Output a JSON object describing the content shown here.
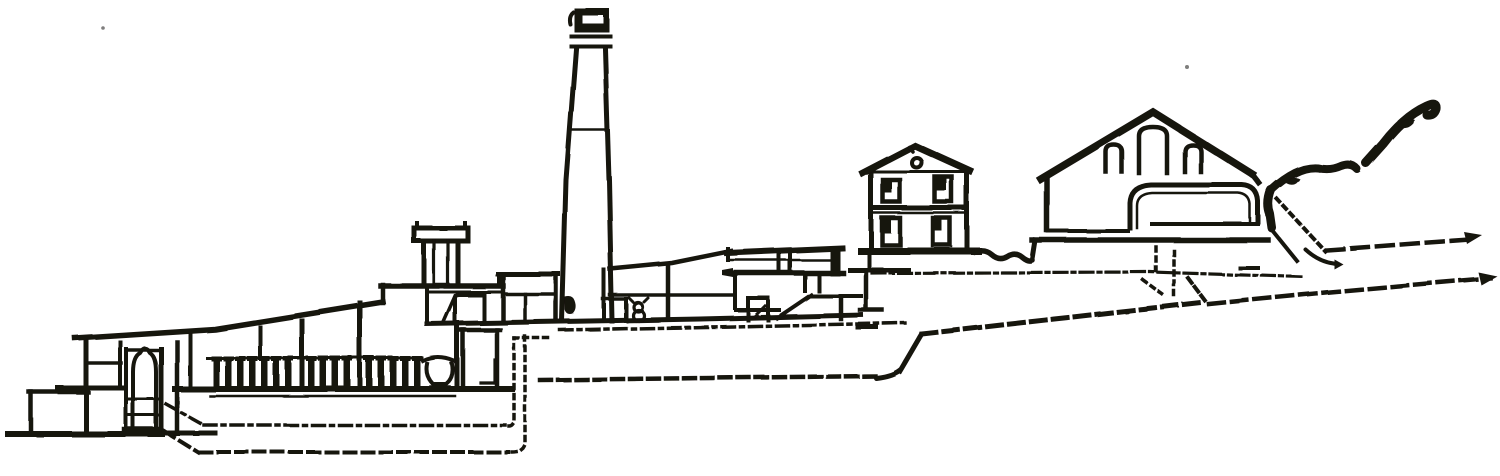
{
  "title": "Sectional elevation engraving of a terraced hillside smelting works with tall central chimney",
  "description": "Old black-ink line engraving, white background, no lettering. From left to right: a low machine house with an enclosed still or vessel; an open shed whose sloping roof covers a long row of short condenser columns and a collecting pot; a furnace block carrying a small capped chimney; a tall tapering smokestack with a moulded cap; a lean-to terrace and an elevated gallery on posts; a two-storey dwelling house with four windows; a large gabled workshop with three arched windows and a vaulted annex; a rocky hillside rising at the far right. Dashed and dotted lines trace underground flues and terraced ground levels descending from right to left.",
  "canvas": {
    "width": 1500,
    "height": 476
  },
  "colors": {
    "ink": "#17120e",
    "paper": "#ffffff"
  },
  "scene": {
    "structures": [
      {
        "id": "ground-baseline-left",
        "label": "Lowest ground line and retaining wall (left)"
      },
      {
        "id": "left-machine-house",
        "label": "Machine house with enclosed vessel and posts"
      },
      {
        "id": "shed-roofline",
        "label": "Long sloping shed roof"
      },
      {
        "id": "condenser-columns",
        "label": "Row of short condenser columns on shed floor"
      },
      {
        "id": "collecting-pot",
        "label": "Flared collecting pot"
      },
      {
        "id": "furnace-box",
        "label": "Furnace chamber blocks"
      },
      {
        "id": "small-chimney",
        "label": "Small capped flue chimney"
      },
      {
        "id": "raised-flue-house",
        "label": "Raised flue house beside the stack"
      },
      {
        "id": "tall-chimney",
        "label": "Tall tapering smokestack with moulded cap"
      },
      {
        "id": "terrace-lean-to",
        "label": "Lean-to roof over middle terrace"
      },
      {
        "id": "figure-eight-mark",
        "label": "Scroll (pump) mark on terrace"
      },
      {
        "id": "elevated-gallery",
        "label": "Elevated gallery on posts with ramp"
      },
      {
        "id": "two-story-house",
        "label": "Two-storey dwelling house with four windows"
      },
      {
        "id": "large-workshop",
        "label": "Gabled workshop with three arched windows"
      },
      {
        "id": "vault-annex",
        "label": "Long vaulted annex with arched doorway"
      },
      {
        "id": "hillside",
        "label": "Rocky hillside outcrop (far right)"
      },
      {
        "id": "underground-flues",
        "label": "Underground flue ducts (dashed/dotted)"
      },
      {
        "id": "terrace-lines",
        "label": "Terraced ground levels (dash-dot lines)"
      }
    ]
  }
}
